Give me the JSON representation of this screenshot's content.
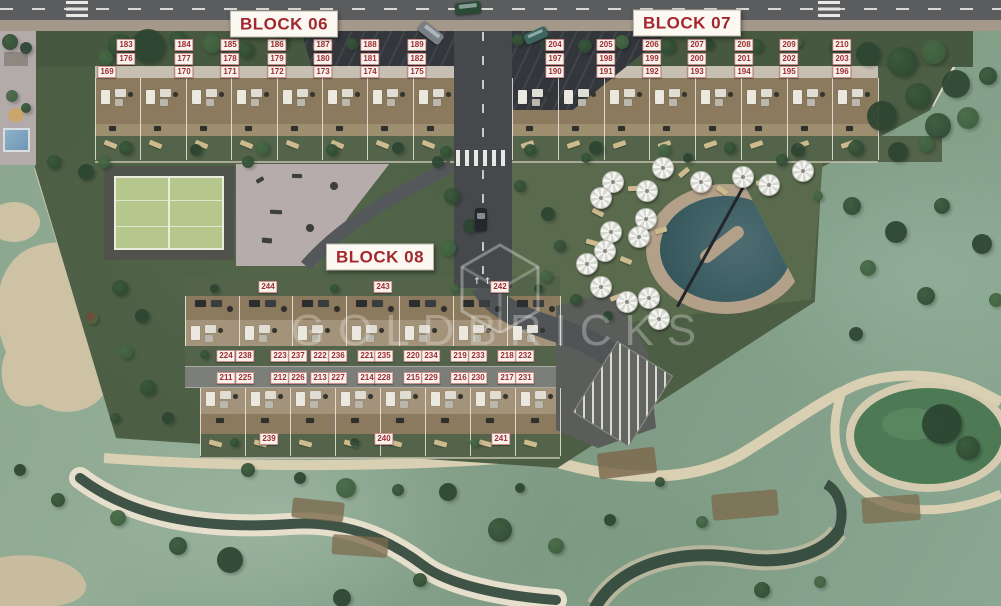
{
  "title": "Residential development site plan",
  "blocks": [
    {
      "label": "BLOCK 06"
    },
    {
      "label": "BLOCK 07"
    },
    {
      "label": "BLOCK 08"
    }
  ],
  "units": {
    "block06_rows": [
      [
        183,
        184,
        185,
        186,
        187,
        188,
        189
      ],
      [
        176,
        177,
        178,
        179,
        180,
        181,
        182
      ],
      [
        169,
        170,
        171,
        172,
        173,
        174,
        175
      ]
    ],
    "block07_rows": [
      [
        204,
        205,
        206,
        207,
        208,
        209,
        210
      ],
      [
        197,
        198,
        199,
        200,
        201,
        202,
        203
      ],
      [
        190,
        191,
        192,
        193,
        194,
        195,
        196
      ]
    ],
    "block08_top_row": [
      244,
      243,
      242
    ],
    "block08_upper_pairs": [
      [
        224,
        238
      ],
      [
        223,
        237
      ],
      [
        222,
        236
      ],
      [
        221,
        235
      ],
      [
        220,
        234
      ],
      [
        219,
        233
      ],
      [
        218,
        232
      ]
    ],
    "block08_lower_pairs": [
      [
        211,
        225
      ],
      [
        212,
        226
      ],
      [
        213,
        227
      ],
      [
        214,
        228
      ],
      [
        215,
        229
      ],
      [
        216,
        230
      ],
      [
        217,
        231
      ]
    ],
    "block08_bottom_row": [
      239,
      240,
      241
    ]
  },
  "watermark": {
    "text": "GOLDBRICKS",
    "logo": "hexagon-cube-logo"
  },
  "colors": {
    "unit_chip_text": "#9e2b30",
    "unit_chip_bg": "#f7f3ec",
    "block_label_text": "#a3272e",
    "golf_green": "#87a18a",
    "development_green": "#4c5e44",
    "terrace_tan": "#8b7a5e",
    "pool_water": "#33585e",
    "pond_green": "#4d7a54",
    "road_gray": "#45494b"
  }
}
